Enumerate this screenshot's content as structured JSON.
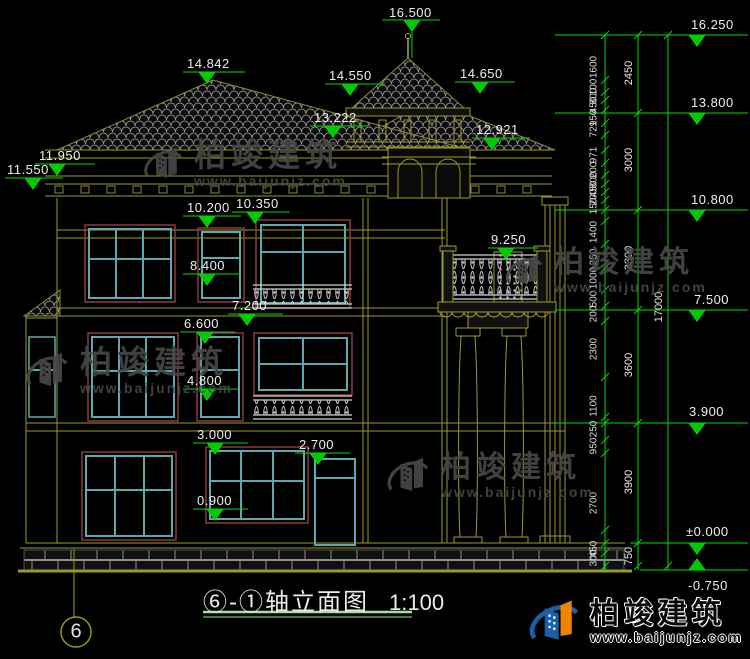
{
  "drawing": {
    "title": "⑥-①轴立面图",
    "scale": "1:100",
    "axis_bubble": "6",
    "building_markers": [
      "16.500",
      "14.842",
      "14.550",
      "14.650",
      "13.222",
      "12.921",
      "11.950",
      "11.550",
      "10.200",
      "10.350",
      "9.250",
      "8.400",
      "7.200",
      "6.600",
      "4.800",
      "3.000",
      "2.700",
      "0.900"
    ],
    "right_markers": [
      "16.250",
      "13.800",
      "10.800",
      "7.500",
      "3.900",
      "±0.000",
      "-0.750"
    ],
    "dims": {
      "col1": [
        "1600",
        "100",
        "800",
        "450",
        "150",
        "729",
        "971",
        "200",
        "800",
        "450",
        "200",
        "150",
        "1400",
        "250",
        "1000",
        "500",
        "200",
        "2300",
        "1100",
        "250",
        "950",
        "2700",
        "450",
        "300"
      ],
      "col2": [
        "2450",
        "3000",
        "3300",
        "3600",
        "3900",
        "750"
      ],
      "col3": "17000"
    }
  },
  "watermark": {
    "name": "柏竣建筑",
    "url": "www.baijunjz.com"
  },
  "colors": {
    "dimension_green": "#00dd00",
    "outline_olive": "#9a9a2a",
    "window_teal": "#5fa8ad",
    "frame_maroon": "#8b3a3a",
    "tile_gray": "#9f9f9f",
    "underline_green": "#a8e0a0"
  }
}
